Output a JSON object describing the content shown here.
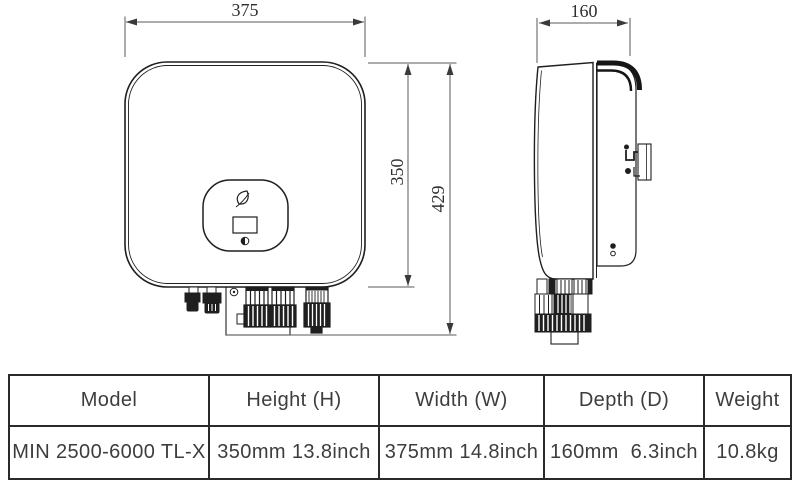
{
  "diagram": {
    "front_view": {
      "width_dim": "375",
      "body_height_dim": "350",
      "overall_height_dim": "429"
    },
    "side_view": {
      "depth_dim": "160"
    }
  },
  "spec_table": {
    "headers": [
      "Model",
      "Height (H)",
      "Width (W)",
      "Depth (D)",
      "Weight"
    ],
    "row": [
      "MIN 2500-6000 TL-X",
      "350mm 13.8inch",
      "375mm 14.8inch",
      "160mm  6.3inch",
      "10.8kg"
    ]
  },
  "colors": {
    "line": "#1f1f1f",
    "dimension_line": "#4d4d4d",
    "table_border": "#2a2a2a",
    "text": "#3d3d3d",
    "background": "#ffffff"
  }
}
